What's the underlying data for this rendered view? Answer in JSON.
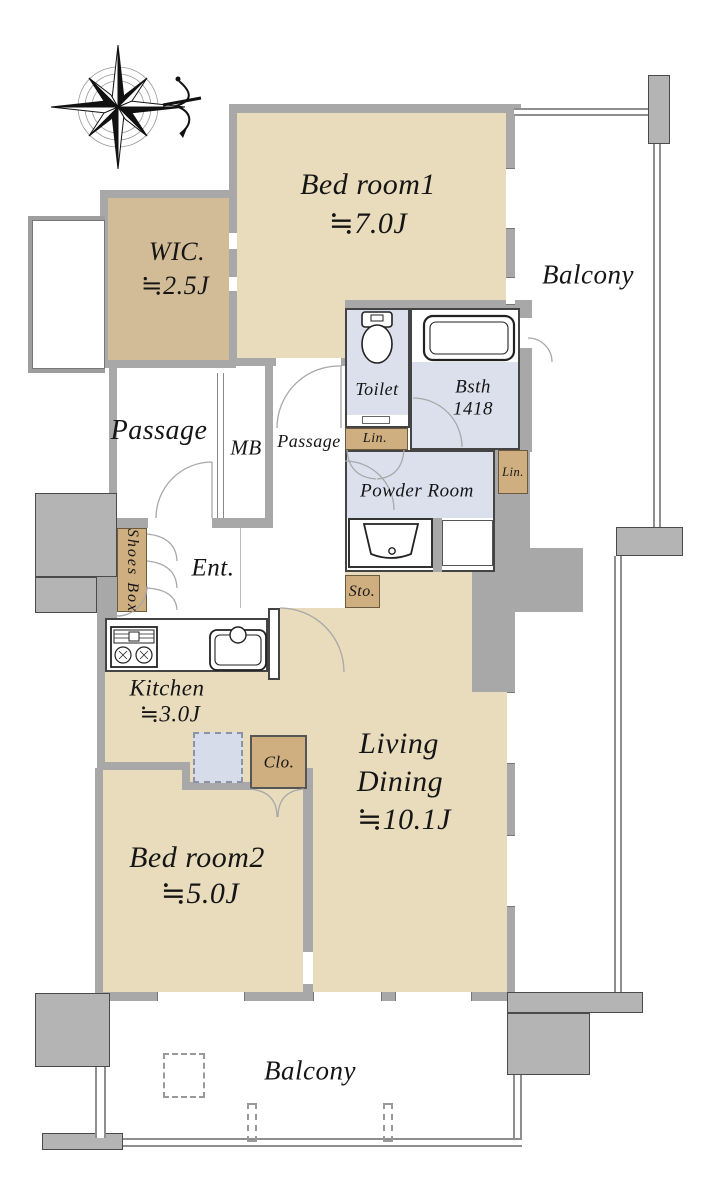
{
  "floorplan": {
    "rooms": {
      "bedroom1": {
        "name": "Bed room1",
        "size": "≒7.0J"
      },
      "wic": {
        "name": "WIC.",
        "size": "≒2.5J"
      },
      "balcony_top": {
        "name": "Balcony"
      },
      "toilet": {
        "name": "Toilet"
      },
      "bath": {
        "name": "Bsth",
        "size": "1418"
      },
      "linen1": {
        "name": "Lin."
      },
      "linen2": {
        "name": "Lin."
      },
      "passage": {
        "name": "Passage"
      },
      "meter_box": {
        "name": "MB"
      },
      "passage2": {
        "name": "Passage"
      },
      "powder_room": {
        "name": "Powder Room"
      },
      "shoes_box": {
        "name": "Shoes Box"
      },
      "entrance": {
        "name": "Ent."
      },
      "storage": {
        "name": "Sto."
      },
      "kitchen": {
        "name": "Kitchen",
        "size": "≒3.0J"
      },
      "closet": {
        "name": "Clo."
      },
      "living_dining": {
        "name": "Living",
        "name2": "Dining",
        "size": "≒10.1J"
      },
      "bedroom2": {
        "name": "Bed room2",
        "size": "≒5.0J"
      },
      "balcony_bottom": {
        "name": "Balcony"
      }
    },
    "icons": [
      "compass-rose-icon",
      "toilet-icon",
      "bathtub-icon",
      "washbasin-icon",
      "sink-icon",
      "stove-icon"
    ],
    "colors": {
      "room_beige": "#e8dcbc",
      "wic_tan": "#d2bc98",
      "closet_tan": "#cfae80",
      "wet_blue": "#dce0ec",
      "fridge_blue": "#d6dcea",
      "wall_gray": "#a8a8a8",
      "pillar_gray": "#b4b4b4"
    }
  }
}
